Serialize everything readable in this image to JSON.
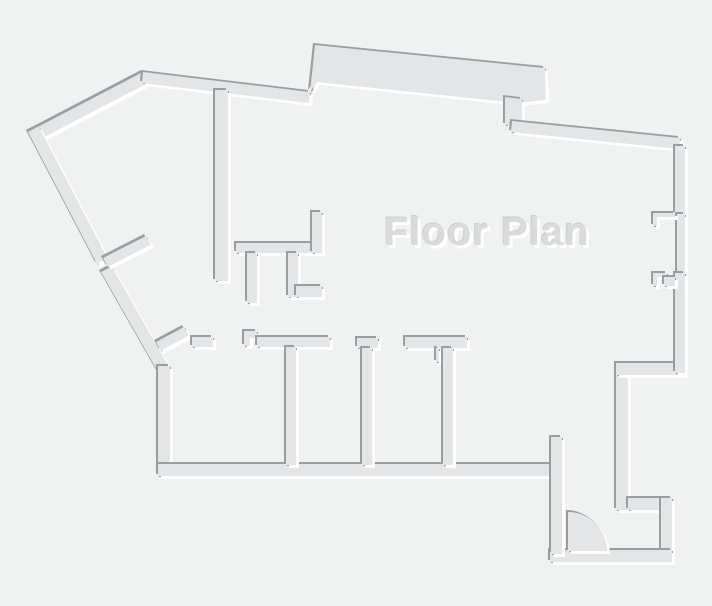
{
  "title": {
    "text": "Floor Plan"
  },
  "canvas": {
    "width": 712,
    "height": 606,
    "background": "#f0f1f1"
  },
  "style": {
    "wall_fill": "#e3e5e6",
    "edge_shadow": "#9b9ea0",
    "edge_highlight": "#ffffff",
    "title_color": "#d8dadc"
  },
  "floor_plan": {
    "walls": [
      {
        "name": "outer-wall-upper-left-diagonal",
        "d": "M28,132 L143,72 L148.6,82.6 L33.6,142.6 Z"
      },
      {
        "name": "outer-wall-left-upper-diagonal",
        "d": "M28,132 L38.6,126.4 L107.6,258.4 L97,264 Z"
      },
      {
        "name": "outer-wall-left-lower-diagonal",
        "d": "M101,272 L111.6,266.4 L168.6,366.4 L158,372 Z"
      },
      {
        "name": "outer-wall-left-vertical",
        "d": "M158,366 h12 v110 h-12 Z"
      },
      {
        "name": "outer-wall-top",
        "d": "M143,72 L310,92 L309,103 L142,83 Z"
      },
      {
        "name": "top-bump-wall",
        "d": "M310,92 L315,45 L545,68 L546,100 L517,103 L317,82 Z"
      },
      {
        "name": "bump-connector-wall",
        "d": "M505,97 L522,99 L522,125 L505,125 Z"
      },
      {
        "name": "outer-wall-top-right",
        "d": "M512,121 L680,138 L679,149 L511,132 Z"
      },
      {
        "name": "bottom-wall-main",
        "d": "M158,464 h396 v12 h-396 Z"
      },
      {
        "name": "right-step-wall",
        "d": "M616,375 h12 v135 h-12 Z"
      },
      {
        "name": "right-jog-wall",
        "d": "M616,363 h69 v12 h-69 Z"
      },
      {
        "name": "right-wall-upper",
        "d": "M675,146 h10 v68 h-10 Z"
      },
      {
        "name": "window-sill",
        "d": "M677,214 h8 v59 h-8 Z"
      },
      {
        "name": "right-wall-lower",
        "d": "M675,273 h10 v100 h-10 Z"
      },
      {
        "name": "window-jamb-top",
        "d": "M653,213 h22 v4 h-18 v9 h-4 Z"
      },
      {
        "name": "window-jamb-bottom",
        "d": "M653,273 h14 v4 h-10 v9 h-4 Z"
      },
      {
        "name": "window-jamb-bottom-fill",
        "d": "M664,277 h11 v9 h-11 Z"
      },
      {
        "name": "entry-hook-top-wall",
        "d": "M628,498 h44 v12 h-44 Z"
      },
      {
        "name": "entry-hook-right-wall",
        "d": "M661,498 h11 v64 h-11 Z"
      },
      {
        "name": "entry-bottom-wall",
        "d": "M550,550 h122 v12 h-122 Z"
      },
      {
        "name": "entry-spur-wall",
        "d": "M551,437 h11 v117 h-11 Z"
      },
      {
        "name": "interior-wall-vertical",
        "d": "M215,90 h13 v191 h-13 Z"
      },
      {
        "name": "interior-wall-h1",
        "d": "M236,243 h86 v10 h-86 Z"
      },
      {
        "name": "interior-riser",
        "d": "M312,212 h10 v41 h-10 Z"
      },
      {
        "name": "interior-stub-a",
        "d": "M247,253 h10 v50 h-10 Z"
      },
      {
        "name": "interior-stub-b",
        "d": "M288,253 h10 v44 h-10 Z"
      },
      {
        "name": "interior-stub-b-arm",
        "d": "M296,286 h26 v11 h-26 Z"
      },
      {
        "name": "door-jamb-diagonal",
        "d": "M103,258 L146,236 L150.7,244.8 L107.7,266.8 Z"
      },
      {
        "name": "corner-stub-diagonal",
        "d": "M156,342 L184,327 L188.7,335.8 L160.7,350.8 Z"
      },
      {
        "name": "header-h0",
        "d": "M192,337 h21 v10 h-21 Z"
      },
      {
        "name": "header-h2-cap",
        "d": "M244,331 h13 v7 h-7 v8 h-6 Z"
      },
      {
        "name": "header-h2",
        "d": "M257,337 h73 v10 h-73 Z"
      },
      {
        "name": "room-divider-w1",
        "d": "M286,347 h10 v118 h-10 Z"
      },
      {
        "name": "room-divider-w2-cap",
        "d": "M357,338 h21 v10 h-21 Z"
      },
      {
        "name": "room-divider-w2",
        "d": "M362,348 h10 v117 h-10 Z"
      },
      {
        "name": "header-h3",
        "d": "M405,337 h62 v11 h-62 Z"
      },
      {
        "name": "room-divider-w3-jamb",
        "d": "M436,348 h3 v14 h-3 Z"
      },
      {
        "name": "room-divider-w3",
        "d": "M443,348 h10 v117 h-10 Z"
      },
      {
        "name": "entry-door-swing",
        "d": "M568,551 L568,512 A39,39 0 0 1 607,551 Z"
      }
    ]
  }
}
